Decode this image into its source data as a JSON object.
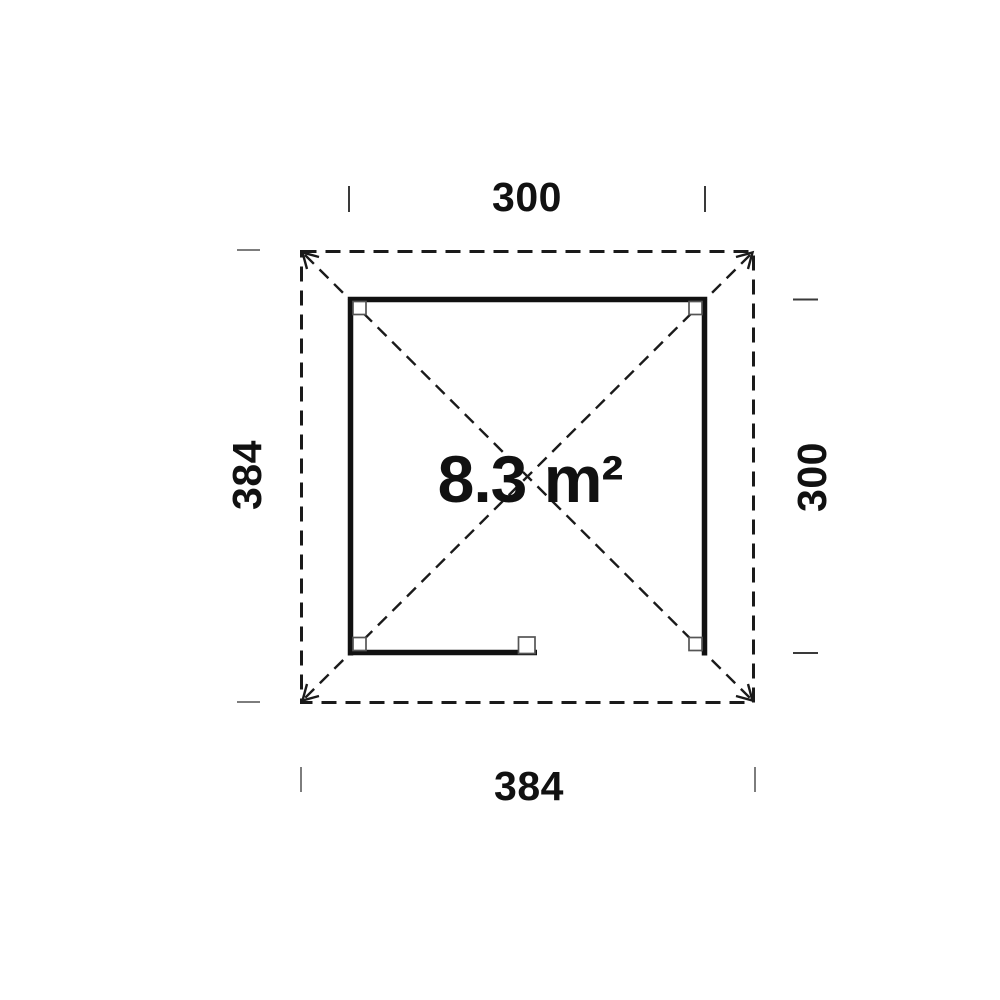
{
  "plan": {
    "type": "gazebo-floor-plan",
    "area_label": "8.3 m²",
    "dimensions": {
      "top": "300",
      "right": "300",
      "bottom": "384",
      "left": "384"
    }
  },
  "colors": {
    "ink": "#111111",
    "wall": "#111111",
    "roof_dash": "#1a1a1a",
    "post_stroke": "#555555",
    "tick_dark": "#3a3a3a",
    "tick_gray": "#7d7d7d",
    "background": "#ffffff"
  }
}
